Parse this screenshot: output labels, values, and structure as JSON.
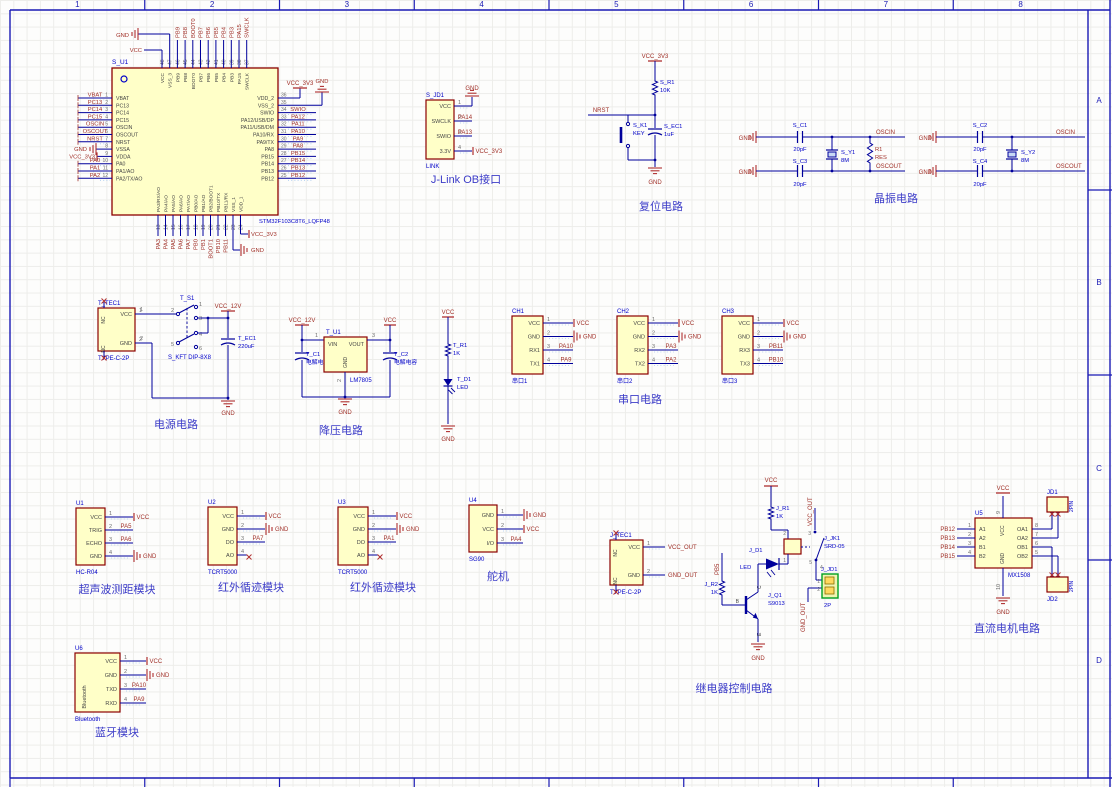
{
  "frame": {
    "top_zones": [
      "1",
      "2",
      "3",
      "4",
      "5",
      "6",
      "7",
      "8"
    ],
    "right_zones": [
      "A",
      "B",
      "C",
      "D"
    ]
  },
  "colors": {
    "wire": "#00009B",
    "net_label": "#A03028",
    "symbol": "#B03030",
    "blue_text": "#0000C8",
    "title": "#3C3CC8",
    "pin_number": "#6E6E6E",
    "pin_name": "#454545",
    "component_fill": "#FFFFC8",
    "component_border": "#8C0000",
    "frame_blue": "#1A1AB4",
    "crystal_fill": "#C8D8F4",
    "connector_green": "#00A020",
    "snap_dots": "#A9CBEF"
  },
  "titles": {
    "jlink": "J-Link OB接口",
    "reset": "复位电路",
    "crystal": "晶振电路",
    "power": "电源电路",
    "buck": "降压电路",
    "serial": "串口电路",
    "ultrasonic": "超声波测距模块",
    "ir1": "红外循迹模块",
    "ir2": "红外循迹模块",
    "servo": "舵机",
    "relay": "继电器控制电路",
    "motor": "直流电机电路",
    "bt": "蓝牙模块"
  },
  "mcu": {
    "designator": "S_U1",
    "part": "STM32F103C8T6_LQFP48",
    "left_pins": [
      {
        "num": "1",
        "name": "VBAT",
        "net": "VBAT",
        "type": "label"
      },
      {
        "num": "2",
        "name": "PC13",
        "net": "PC13",
        "type": "label"
      },
      {
        "num": "3",
        "name": "PC14",
        "net": "PC14",
        "type": "label"
      },
      {
        "num": "4",
        "name": "PC15",
        "net": "PC15",
        "type": "label"
      },
      {
        "num": "5",
        "name": "OSCIN",
        "net": "OSCIN",
        "type": "label"
      },
      {
        "num": "6",
        "name": "OSCOUT",
        "net": "OSCOUT",
        "type": "label"
      },
      {
        "num": "7",
        "name": "NRST",
        "net": "NRST",
        "type": "label"
      },
      {
        "num": "8",
        "name": "VSSA",
        "net": "GND",
        "type": "gnd_l"
      },
      {
        "num": "9",
        "name": "VDDA",
        "net": "VCC_3V3",
        "type": "pwr_l"
      },
      {
        "num": "10",
        "name": "PA0",
        "net": "PA0",
        "type": "label"
      },
      {
        "num": "11",
        "name": "PA1/AO",
        "net": "PA1",
        "type": "label"
      },
      {
        "num": "12",
        "name": "PA2/TX/AO",
        "net": "PA2",
        "type": "label"
      }
    ],
    "right_pins": [
      {
        "num": "36",
        "name": "VDD_2",
        "net": "VCC_3V3",
        "type": "pwr_up"
      },
      {
        "num": "35",
        "name": "VSS_2",
        "net": "GND",
        "type": "gnd_up"
      },
      {
        "num": "34",
        "name": "SWIO",
        "net": "SWIO",
        "type": "label"
      },
      {
        "num": "33",
        "name": "PA12/USB/DP",
        "net": "PA12",
        "type": "label"
      },
      {
        "num": "32",
        "name": "PA11/USB/DM",
        "net": "PA11",
        "type": "label"
      },
      {
        "num": "31",
        "name": "PA10/RX",
        "net": "PA10",
        "type": "label"
      },
      {
        "num": "30",
        "name": "PA9/TX",
        "net": "PA9",
        "type": "label"
      },
      {
        "num": "29",
        "name": "PA8",
        "net": "PA8",
        "type": "label"
      },
      {
        "num": "28",
        "name": "PB15",
        "net": "PB15",
        "type": "label"
      },
      {
        "num": "27",
        "name": "PB14",
        "net": "PB14",
        "type": "label"
      },
      {
        "num": "26",
        "name": "PB13",
        "net": "PB13",
        "type": "label"
      },
      {
        "num": "25",
        "name": "PB12",
        "net": "PB12",
        "type": "label"
      }
    ],
    "top_pins": [
      {
        "num": "48",
        "name": "VCC",
        "net": "VCC",
        "type": "pwr_tl"
      },
      {
        "num": "47",
        "name": "VSS_3",
        "net": "GND",
        "type": "gnd_tl"
      },
      {
        "num": "46",
        "name": "PB9",
        "net": "PB9",
        "type": "label"
      },
      {
        "num": "45",
        "name": "PB8",
        "net": "PB8",
        "type": "label"
      },
      {
        "num": "44",
        "name": "BOOT0",
        "net": "BOOT0",
        "type": "label"
      },
      {
        "num": "43",
        "name": "PB7",
        "net": "PB7",
        "type": "label"
      },
      {
        "num": "42",
        "name": "PB6",
        "net": "PB6",
        "type": "label"
      },
      {
        "num": "41",
        "name": "PB5",
        "net": "PB5",
        "type": "label"
      },
      {
        "num": "40",
        "name": "PB4",
        "net": "PB4",
        "type": "label"
      },
      {
        "num": "39",
        "name": "PB3",
        "net": "PB3",
        "type": "label"
      },
      {
        "num": "38",
        "name": "PA15",
        "net": "PA15",
        "type": "label"
      },
      {
        "num": "37",
        "name": "SWCLK",
        "net": "SWCLK",
        "type": "label"
      }
    ],
    "bottom_pins": [
      {
        "num": "13",
        "name": "PA3/RX/AO",
        "net": "PA3",
        "type": "label"
      },
      {
        "num": "14",
        "name": "PA4/AO",
        "net": "PA4",
        "type": "label"
      },
      {
        "num": "15",
        "name": "PA5/AO",
        "net": "PA5",
        "type": "label"
      },
      {
        "num": "16",
        "name": "PA6/AO",
        "net": "PA6",
        "type": "label"
      },
      {
        "num": "17",
        "name": "PA7/AO",
        "net": "PA7",
        "type": "label"
      },
      {
        "num": "18",
        "name": "PB0/AO",
        "net": "PB0",
        "type": "label"
      },
      {
        "num": "19",
        "name": "PB1/AO",
        "net": "PB1",
        "type": "label"
      },
      {
        "num": "20",
        "name": "PB2/BOOT1",
        "net": "BOOT1",
        "type": "label"
      },
      {
        "num": "21",
        "name": "PB10/TX",
        "net": "PB10",
        "type": "label"
      },
      {
        "num": "22",
        "name": "PB11/RX",
        "net": "PB11",
        "type": "label"
      },
      {
        "num": "23",
        "name": "VSS_1",
        "net": "GND",
        "type": "gnd_br"
      },
      {
        "num": "24",
        "name": "VDD_1",
        "net": "VCC_3V3",
        "type": "pwr_br"
      }
    ]
  },
  "modules": {
    "jlink": {
      "designator": "S_JD1",
      "part": "LINK",
      "pins": [
        {
          "name": "VCC",
          "num": "1",
          "net": "GND",
          "type": "gndup"
        },
        {
          "name": "SWCLK",
          "num": "2",
          "net": "PA14",
          "type": "label"
        },
        {
          "name": "SWIO",
          "num": "3",
          "net": "PA13",
          "type": "label"
        },
        {
          "name": "3.3V",
          "num": "4",
          "net": "VCC_3V3",
          "type": "pwr"
        }
      ]
    },
    "ch1": {
      "designator": "CH1",
      "part": "串口1",
      "pins": [
        {
          "name": "VCC",
          "num": "1",
          "net": "VCC",
          "type": "pwr"
        },
        {
          "name": "GND",
          "num": "2",
          "net": "GND",
          "type": "gnd"
        },
        {
          "name": "RX1",
          "num": "3",
          "net": "PA10",
          "type": "label"
        },
        {
          "name": "TX1",
          "num": "4",
          "net": "PA9",
          "type": "label"
        }
      ]
    },
    "ch2": {
      "designator": "CH2",
      "part": "串口2",
      "pins": [
        {
          "name": "VCC",
          "num": "1",
          "net": "VCC",
          "type": "pwr"
        },
        {
          "name": "GND",
          "num": "2",
          "net": "GND",
          "type": "gnd"
        },
        {
          "name": "RX2",
          "num": "3",
          "net": "PA3",
          "type": "label"
        },
        {
          "name": "TX2",
          "num": "4",
          "net": "PA2",
          "type": "label"
        }
      ]
    },
    "ch3": {
      "designator": "CH3",
      "part": "串口3",
      "pins": [
        {
          "name": "VCC",
          "num": "1",
          "net": "VCC",
          "type": "pwr"
        },
        {
          "name": "GND",
          "num": "2",
          "net": "GND",
          "type": "gnd"
        },
        {
          "name": "RX3",
          "num": "3",
          "net": "PB11",
          "type": "label"
        },
        {
          "name": "TX3",
          "num": "4",
          "net": "PB10",
          "type": "label"
        }
      ]
    },
    "u1": {
      "designator": "U1",
      "part": "HC-R04",
      "pins": [
        {
          "name": "VCC",
          "num": "1",
          "net": "VCC",
          "type": "pwr"
        },
        {
          "name": "TRIG",
          "num": "2",
          "net": "PA5",
          "type": "label"
        },
        {
          "name": "ECHO",
          "num": "3",
          "net": "PA6",
          "type": "label"
        },
        {
          "name": "GND",
          "num": "4",
          "net": "GND",
          "type": "gnd"
        }
      ]
    },
    "u2": {
      "designator": "U2",
      "part": "TCRT5000",
      "pins": [
        {
          "name": "VCC",
          "num": "1",
          "net": "VCC",
          "type": "pwr"
        },
        {
          "name": "GND",
          "num": "2",
          "net": "GND",
          "type": "gnd"
        },
        {
          "name": "DO",
          "num": "3",
          "net": "PA7",
          "type": "label"
        },
        {
          "name": "AO",
          "num": "4",
          "net": "",
          "type": "nc"
        }
      ]
    },
    "u3": {
      "designator": "U3",
      "part": "TCRT5000",
      "pins": [
        {
          "name": "VCC",
          "num": "1",
          "net": "VCC",
          "type": "pwr"
        },
        {
          "name": "GND",
          "num": "2",
          "net": "GND",
          "type": "gnd"
        },
        {
          "name": "DO",
          "num": "3",
          "net": "PA1",
          "type": "label"
        },
        {
          "name": "AO",
          "num": "4",
          "net": "",
          "type": "nc"
        }
      ]
    },
    "u4": {
      "designator": "U4",
      "part": "SG90",
      "pins": [
        {
          "name": "GND",
          "num": "1",
          "net": "GND",
          "type": "gnd"
        },
        {
          "name": "VCC",
          "num": "2",
          "net": "VCC",
          "type": "pwr"
        },
        {
          "name": "I/O",
          "num": "3",
          "net": "PA4",
          "type": "label"
        }
      ]
    },
    "u6": {
      "designator": "U6",
      "part": "Bluetooth",
      "side_text": "Bluetooth",
      "pins": [
        {
          "name": "VCC",
          "num": "1",
          "net": "VCC",
          "type": "pwr"
        },
        {
          "name": "GND",
          "num": "2",
          "net": "GND",
          "type": "gnd"
        },
        {
          "name": "TXD",
          "num": "3",
          "net": "PA10",
          "type": "label"
        },
        {
          "name": "RXD",
          "num": "4",
          "net": "PA9",
          "type": "label"
        }
      ]
    },
    "t_tec1": {
      "designator": "T_TEC1",
      "part": "TYPE-C-2P",
      "nc_label": "NC",
      "pins": [
        {
          "name": "VCC",
          "num": "1",
          "net": "",
          "type": "none"
        },
        {
          "name": "GND",
          "num": "2",
          "net": "",
          "type": "none"
        }
      ]
    },
    "j_tec1": {
      "designator": "J_TEC1",
      "part": "TYPE-C-2P",
      "nc_label": "NC",
      "pins": [
        {
          "name": "VCC",
          "num": "1",
          "net": "VCC_OUT",
          "type": "label_r"
        },
        {
          "name": "GND",
          "num": "2",
          "net": "GND_OUT",
          "type": "label_r"
        }
      ]
    },
    "u5": {
      "designator": "U5",
      "part": "MX1508",
      "vcc_name": "VCC",
      "vcc_num": "9",
      "vcc_net": "VCC",
      "gnd_name": "GND",
      "gnd_num": "10",
      "gnd_net": "GND",
      "left_pins": [
        {
          "name": "A1",
          "num": "1",
          "net": "PB12"
        },
        {
          "name": "A2",
          "num": "2",
          "net": "PB13"
        },
        {
          "name": "B1",
          "num": "3",
          "net": "PB14"
        },
        {
          "name": "B2",
          "num": "4",
          "net": "PB15"
        }
      ],
      "right_pins": [
        {
          "name": "OA1",
          "num": "8"
        },
        {
          "name": "OA2",
          "num": "7"
        },
        {
          "name": "OB1",
          "num": "6"
        },
        {
          "name": "OB2",
          "num": "5"
        }
      ],
      "jd1": {
        "designator": "JD1",
        "part": "2PIN"
      },
      "jd2": {
        "designator": "JD2",
        "part": "2PIN"
      }
    }
  },
  "reset": {
    "pwr": "VCC_3V3",
    "r_des": "S_R1",
    "r_val": "10K",
    "net": "NRST",
    "k_des": "S_K1",
    "k_val": "KEY",
    "c_des": "S_EC1",
    "c_val": "1uF",
    "gnd": "GND"
  },
  "crystal": {
    "gnd": "GND",
    "oscin": "OSCIN",
    "oscout": "OSCOUT",
    "c1_des": "S_C1",
    "c1_val": "20pF",
    "c3_des": "S_C3",
    "c3_val": "20pF",
    "y1_des": "S_Y1",
    "y1_val": "8M",
    "r_des": "R1",
    "r_val": "RES",
    "c2_des": "S_C2",
    "c2_val": "20pF",
    "c4_des": "S_C4",
    "c4_val": "20pF",
    "y2_des": "S_Y2",
    "y2_val": "8M"
  },
  "power": {
    "sw_des": "T_S1",
    "sw_part": "S_KFT DIP-8X8",
    "rail": "VCC_12V",
    "cap_des": "T_EC1",
    "cap_val": "220uF",
    "gnd": "GND",
    "sw_pins": [
      "1",
      "2",
      "3",
      "4",
      "5",
      "6"
    ],
    "pin1": "1",
    "pin2": "2"
  },
  "buck": {
    "rail_in": "VCC_12V",
    "rail_out": "VCC",
    "u_des": "T_U1",
    "u_part": "LM7805",
    "pin_vin": "VIN",
    "pin_vout": "VOUT",
    "pin_gnd": "GND",
    "n1": "1",
    "n2": "2",
    "n3": "3",
    "c1_des": "T_C1",
    "c1_val": "电解电容",
    "c2_des": "T_C2",
    "c2_val": "电解电容",
    "gnd": "GND"
  },
  "led": {
    "pwr": "VCC",
    "r_des": "T_R1",
    "r_val": "1K",
    "d_des": "T_D1",
    "d_val": "LED",
    "gnd": "GND"
  },
  "relay": {
    "pwr": "VCC",
    "gnd": "GND",
    "r1_des": "J_R1",
    "r1_val": "1K",
    "led_des": "J_D1",
    "led_val": "LED",
    "coil_des": "J_JK1",
    "coil_part": "SRD-05",
    "coil_pin_top": "2",
    "coil_pin_bottom": "1",
    "sw_pin_top": "3",
    "sw_pin_a": "4",
    "sw_pin_b": "5",
    "q_des": "J_Q1",
    "q_part": "S9013",
    "lbl_b": "B",
    "lbl_c": "C",
    "lbl_e": "E",
    "r2_des": "J_R2",
    "r2_val": "1K",
    "base_net": "PB5",
    "vcc_out": "VCC_OUT",
    "gnd_out": "GND_OUT",
    "conn_des": "J_JD1",
    "conn_part": "2P",
    "conn_pin1": "1",
    "conn_pin2": "2"
  }
}
